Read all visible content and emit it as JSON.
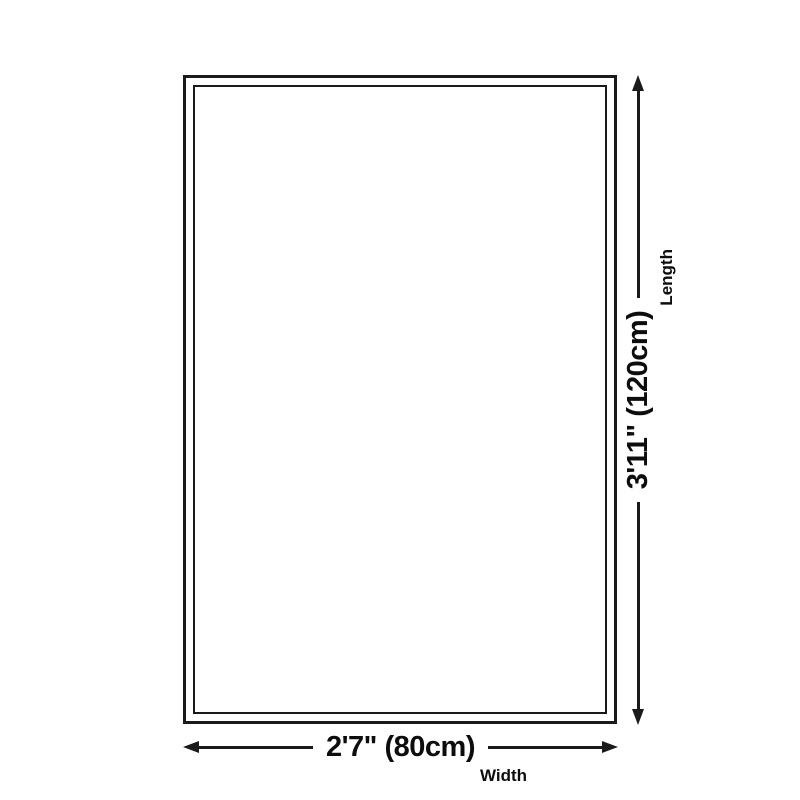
{
  "diagram": {
    "type": "rug-size-diagram",
    "background_color": "#ffffff",
    "line_color": "#1a1a1a",
    "text_color": "#0d0d0d",
    "length_dimension": {
      "value": "3'11\" (120cm)",
      "label": "Length"
    },
    "width_dimension": {
      "value": "2'7\" (80cm)",
      "label": "Width"
    }
  }
}
